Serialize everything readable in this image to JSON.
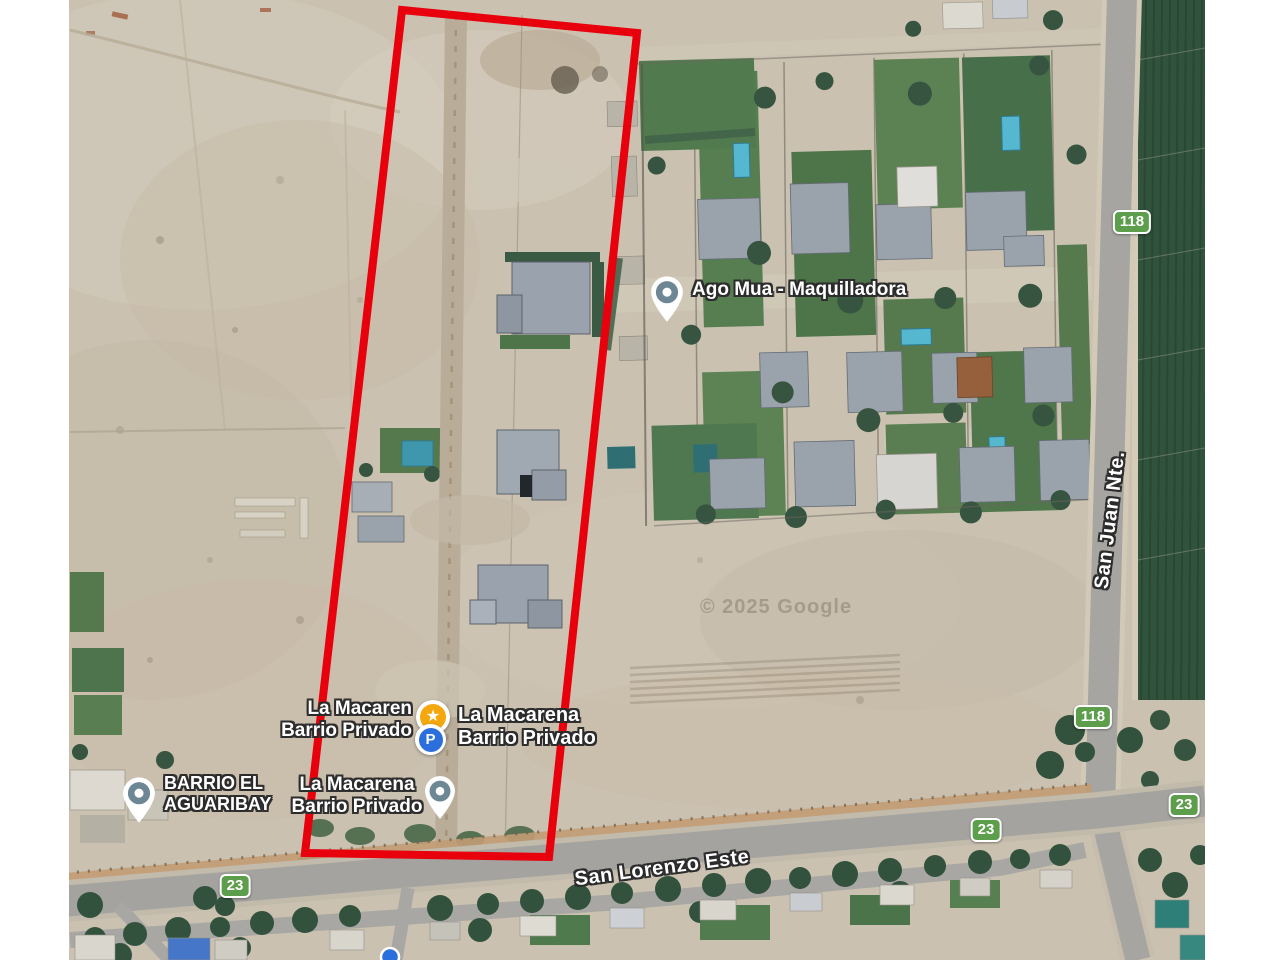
{
  "attribution": "© 2025 Google",
  "pois": {
    "ago_mua": {
      "name": "Ago Mua - Maquilladora"
    },
    "la_macarena_west": {
      "line1": "La Macaren",
      "line2": "Barrio Privado"
    },
    "la_macarena_east": {
      "line1": "La Macarena",
      "line2": "Barrio Privado"
    },
    "la_macarena_south": {
      "line1": "La Macarena",
      "line2": "Barrio Privado"
    },
    "barrio_el_aguaribay": {
      "line1": "BARRIO EL",
      "line2": "AGUARIBAY"
    }
  },
  "roads": {
    "san_lorenzo_este": "San Lorenzo Este",
    "san_juan_nte": "San Juan Nte."
  },
  "route_badges": {
    "route_23": "23",
    "route_118": "118"
  },
  "marker_glyphs": {
    "star": "★",
    "parking": "P"
  },
  "colors": {
    "parcel_outline_red": "#e8000d",
    "badge_green": "#5d9e4c",
    "poi_marker_slate": "#6e8795",
    "star_marker_amber": "#f4a80e",
    "parking_marker_blue": "#2a6fdb"
  }
}
